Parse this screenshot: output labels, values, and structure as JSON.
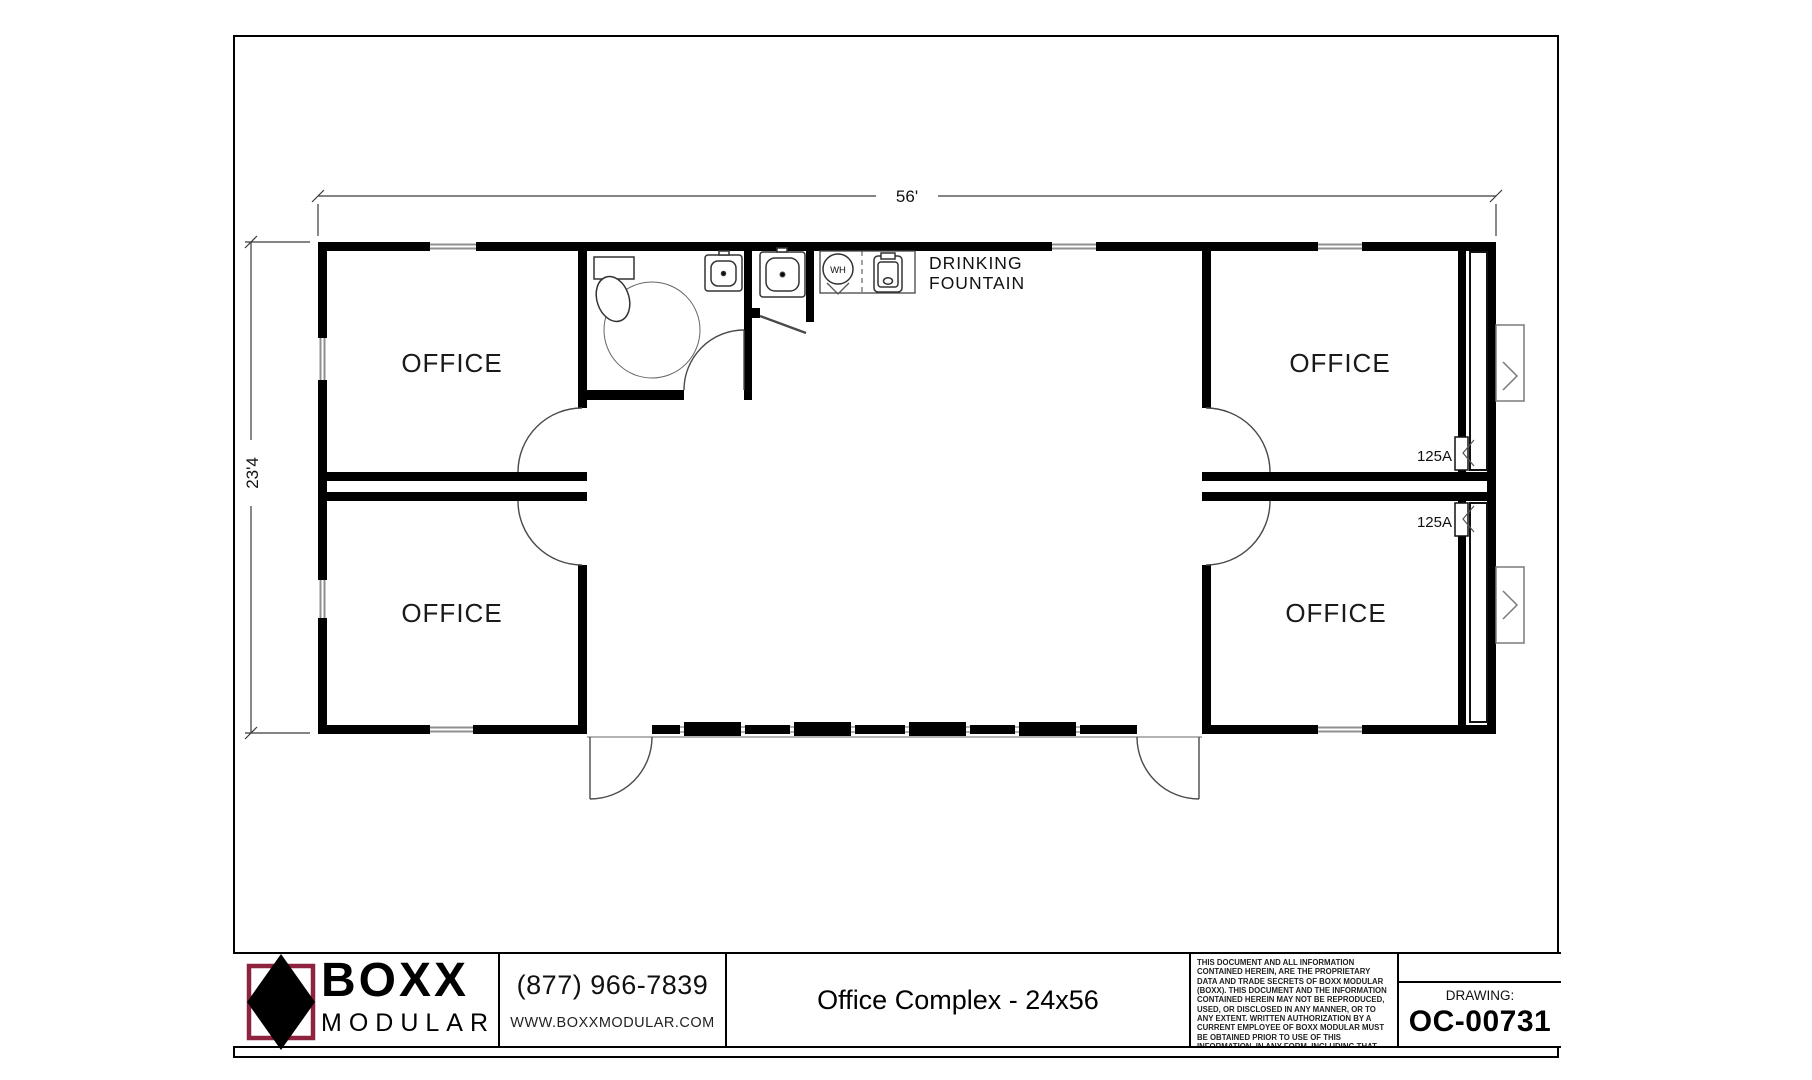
{
  "sheet": {
    "background": "#ffffff",
    "line_color": "#000000"
  },
  "floor_plan": {
    "top_dimension_label": "56'",
    "left_dimension_label": "23'4",
    "office_labels": [
      "OFFICE",
      "OFFICE",
      "OFFICE",
      "OFFICE"
    ],
    "drinking_fountain_label_line1": "DRINKING",
    "drinking_fountain_label_line2": "FOUNTAIN",
    "water_heater_label": "WH",
    "electrical_panel_top_label": "125A",
    "electrical_panel_bottom_label": "125A"
  },
  "title_block": {
    "logo_word_top": "BOXX",
    "logo_word_bottom": "MODULAR",
    "logo_accent_color": "#8e2340",
    "phone": "(877) 966-7839",
    "website": "WWW.BOXXMODULAR.COM",
    "drawing_title": "Office Complex - 24x56",
    "legal_text": "THIS DOCUMENT AND ALL INFORMATION CONTAINED HEREIN, ARE THE PROPRIETARY DATA AND TRADE SECRETS OF BOXX MODULAR (BOXX). THIS DOCUMENT AND THE INFORMATION CONTAINED HEREIN MAY NOT BE REPRODUCED, USED, OR DISCLOSED IN ANY MANNER, OR TO ANY EXTENT.  WRITTEN AUTHORIZATION BY A CURRENT EMPLOYEE OF BOXX MODULAR MUST BE OBTAINED PRIOR TO USE OF THIS INFORMATION, IN ANY FORM, INCLUDING THAT WHICH IS REPRESENTED BY THIS COMPLETE PAGE.",
    "drawing_caption": "DRAWING:",
    "drawing_number": "OC-00731"
  }
}
